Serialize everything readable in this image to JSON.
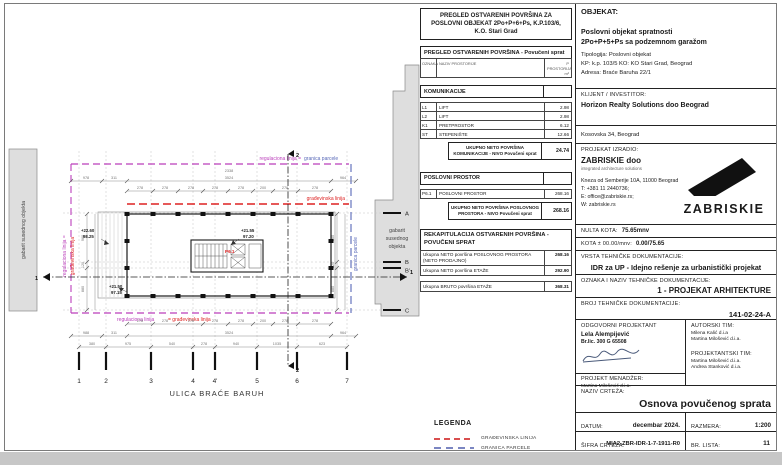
{
  "plan": {
    "street": "ULICA BRAĆE BARUH",
    "neighbor_left": "gabarit susednog objekta",
    "neighbor_right_lines": [
      "gabarit",
      "susednog",
      "objekta"
    ],
    "axis_numbers": [
      "1",
      "2",
      "3",
      "4",
      "4'",
      "5",
      "6",
      "7"
    ],
    "axis_letters": [
      "A",
      "B",
      "B'",
      "C"
    ],
    "boundary_labels": {
      "regulaciona": "regulaciona linija",
      "regulaciona_eq": "regulaciona linija =",
      "granica": "granica parcele",
      "gradjevinska": "građevinska linija",
      "eq_gradjevinska": "= građevinska linija"
    },
    "levels": [
      {
        "rel": "+22.60",
        "abs": "98.25"
      },
      {
        "rel": "+21.50",
        "abs": "97.15"
      },
      {
        "rel": "+21.55",
        "abs": "97.20"
      }
    ],
    "room": "P6.1",
    "section_marks": {
      "horizontal": "1",
      "vertical": "2"
    },
    "dims": {
      "top_total": "2338",
      "top_outer": [
        "978",
        "311",
        "3524",
        "964"
      ],
      "top_inner": [
        "278",
        "278",
        "278",
        "278",
        "278",
        "200",
        "278",
        "278"
      ],
      "bottom_inner": [
        "278",
        "278",
        "278",
        "278",
        "278",
        "200",
        "278",
        "278"
      ],
      "bottom_outer": [
        "988",
        "311",
        "3524",
        "964"
      ],
      "bottom_axes": [
        "380",
        "975",
        "540",
        "278",
        "940",
        "1035",
        "623"
      ],
      "left": [
        "960",
        "120",
        "880"
      ],
      "right": [
        "960",
        "120",
        "880"
      ]
    }
  },
  "tables": {
    "title": "PREGLED OSTVARENIH POVRŠINA ZA POSLOVNI OBJEKAT 2Po+P+6+Ps, K.P.103/6, K.O. Stari Grad",
    "header": "PREGLED OSTVARENIH POVRŠINA - Povučeni sprat",
    "col_oznaka": "OZNAKA",
    "col_naziv": "NAZIV PROSTORIJE",
    "col_p": "P PROSTORIJA m²",
    "komunikacije": {
      "section": "KOMUNIKACIJE",
      "rows": [
        [
          "L1",
          "LIFT",
          "2.98"
        ],
        [
          "L2",
          "LIFT",
          "2.98"
        ],
        [
          "K1",
          "PRETPROSTOR",
          "6.12"
        ],
        [
          "ST",
          "STEPENIŠTE",
          "12.66"
        ]
      ],
      "total_label": "UKUPNO NETO POVRŠINA KOMUNIKACIJE - NIVO Povučeni sprat",
      "total": "24.74"
    },
    "poslovni": {
      "section": "POSLOVNI PROSTOR",
      "rows": [
        [
          "P6.1",
          "POSLOVNI PROSTOR",
          "268.16"
        ]
      ],
      "total_label": "UKUPNO NETO POVRŠINA POSLOVNOG PROSTORA - NIVO Povučeni sprat",
      "total": "268.16"
    },
    "rekap": {
      "title": "REKAPITULACIJA OSTVARENIH POVRŠINA - POVUČENI SPRAT",
      "rows": [
        [
          "Ukupna NETO površina POSLOVNOG PROSTORA (NETO PRODAJNO)",
          "268.16"
        ],
        [
          "Ukupna NETO površina ETAŽE",
          "292.90"
        ],
        [
          "Ukupna BRUTO površina ETAŽE",
          "368.31"
        ]
      ]
    }
  },
  "legend": {
    "title": "LEGENDA",
    "items": [
      {
        "label": "GRAĐEVINSKA LINIJA",
        "color": "#d94f4f",
        "style": "dashed"
      },
      {
        "label": "GRANICA PARCELE",
        "color": "#7b86c2",
        "style": "dashed"
      },
      {
        "label": "REGULACIONA LINIJA",
        "color": "#c05ec0",
        "style": "dash-dot"
      }
    ]
  },
  "titleblock": {
    "objekat_label": "OBJEKAT:",
    "objekat_line1": "Poslovni objekat spratnosti",
    "objekat_line2": "2Po+P+5+Ps sa podzemnom garažom",
    "tipologija": "Tipologija:  Poslovni objekat",
    "kp": "KP: k.p. 103/5 KO: KO Stari Grad, Beograd",
    "adresa": "Adresa: Braće Baruha 22/1",
    "klijent_label": "KLIJENT / INVESTITOR:",
    "klijent": "Horizon Realty Solutions doo Beograd",
    "klijent_adresa": "Kosovska 34, Beograd",
    "izradio_label": "PROJEKAT IZRADIO:",
    "firma": "ZABRISKIE doo",
    "firma_tag": "integrated architecture solutions",
    "firma_adresa": "Kneza od Semberije 10A, 11000 Beograd",
    "firma_t": "T: +381 11 2440736;",
    "firma_e": "E: office@zabriskie.rs;",
    "firma_w": "W: zabriskie.rs",
    "logo_text": "ZABRISKIE",
    "nulta_label": "NULTA KOTA:",
    "nulta": "75.65mnv",
    "kota_label": "KOTA ± 00.00/mnv:",
    "kota": "0.00/75.65",
    "vrsta_label": "VRSTA TEHNIČKE DOKUMENTACIJE:",
    "vrsta": "IDR za UP - Idejno rešenje za urbanistički projekat",
    "oznaka_label": "OZNAKA I NAZIV TEHNIČKE DOKUMENTACIJE:",
    "oznaka": "1 - PROJEKAT ARHITEKTURE",
    "broj_label": "BROJ TEHNIČKE DOKUMENTACIJE:",
    "broj": "141-02-24-A",
    "odg_label": "ODGOVORNI PROJEKTANT",
    "odg_name": "Lela Alempijević",
    "odg_lic": "Br.lic. 300 G 65508",
    "autorski_label": "AUTORSKI TIM:",
    "autorski": [
      "Milena Kalić d.i.a",
      "Martina Milošević d.i.a."
    ],
    "projektantski_label": "PROJEKTANTSKI TIM:",
    "projektantski": [
      "Martina Milošević d.i.a.",
      "Andrea Stanković d.i.a."
    ],
    "menadzer_label": "PROJEKT MENADŽER:",
    "menadzer": "Martina Milošević d.i.a.",
    "naziv_label": "NAZIV CRTEŽA:",
    "naziv": "Osnova povučenog sprata",
    "datum_label": "DATUM:",
    "datum": "decembar 2024.",
    "razmera_label": "RAZMERA:",
    "razmera": "1:200",
    "sifra_label": "ŠIFRA CRTEŽA:",
    "sifra": "MIA2-ZBR-IDR-1-7-1911-R0",
    "lista_label": "BR. LISTA:",
    "lista": "11"
  }
}
